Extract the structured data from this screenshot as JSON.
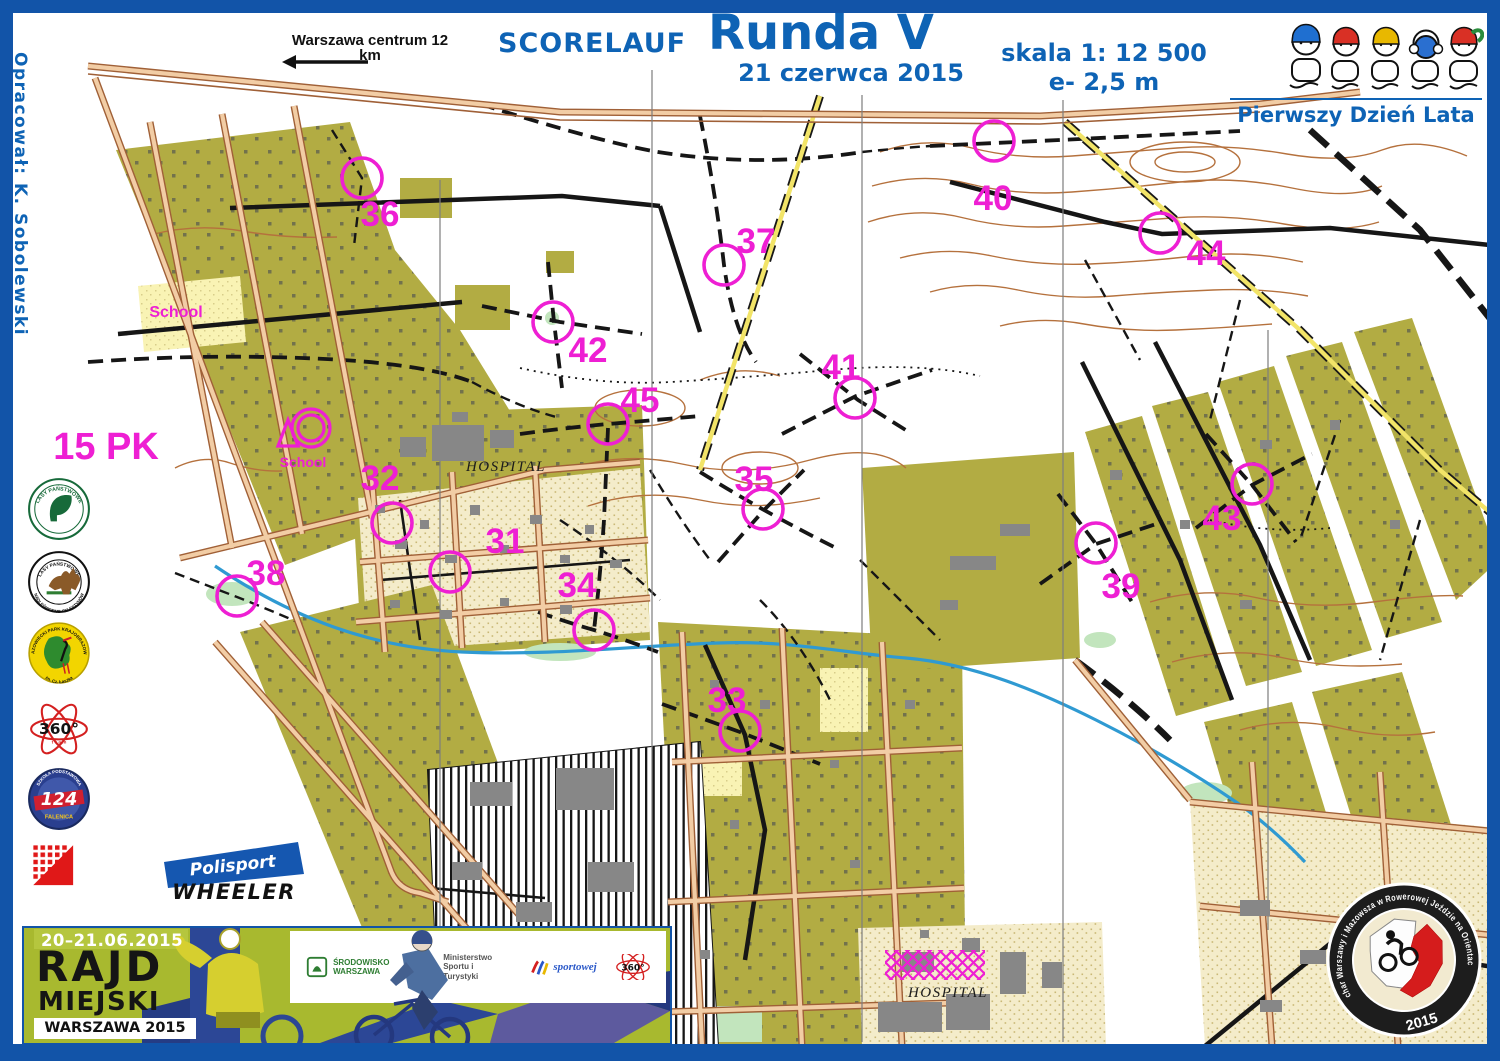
{
  "frame": {
    "border_color": "#1254a8",
    "background": "#ffffff"
  },
  "header": {
    "direction_note": "Warszawa centrum 12 km",
    "event_type": "SCORELAUF",
    "title": "Runda V",
    "date": "21 czerwca 2015",
    "scale": "skala 1: 12 500",
    "equidistance": "e- 2,5 m",
    "season_note": "Pierwszy Dzień Lata",
    "author": "Opracował: K. Sobolewski"
  },
  "map": {
    "control_color": "#ee1fd3",
    "controls": [
      {
        "num": "31",
        "cx": 450,
        "cy": 572,
        "lx": 505,
        "ly": 553
      },
      {
        "num": "32",
        "cx": 392,
        "cy": 523,
        "lx": 380,
        "ly": 490
      },
      {
        "num": "33",
        "cx": 740,
        "cy": 731,
        "lx": 727,
        "ly": 712
      },
      {
        "num": "34",
        "cx": 594,
        "cy": 630,
        "lx": 577,
        "ly": 597
      },
      {
        "num": "35",
        "cx": 763,
        "cy": 509,
        "lx": 754,
        "ly": 491
      },
      {
        "num": "36",
        "cx": 362,
        "cy": 178,
        "lx": 380,
        "ly": 226
      },
      {
        "num": "37",
        "cx": 724,
        "cy": 265,
        "lx": 756,
        "ly": 253
      },
      {
        "num": "38",
        "cx": 237,
        "cy": 596,
        "lx": 266,
        "ly": 585
      },
      {
        "num": "39",
        "cx": 1096,
        "cy": 543,
        "lx": 1121,
        "ly": 598
      },
      {
        "num": "40",
        "cx": 994,
        "cy": 141,
        "lx": 993,
        "ly": 210
      },
      {
        "num": "41",
        "cx": 855,
        "cy": 398,
        "lx": 841,
        "ly": 379
      },
      {
        "num": "42",
        "cx": 553,
        "cy": 322,
        "lx": 588,
        "ly": 362
      },
      {
        "num": "43",
        "cx": 1252,
        "cy": 484,
        "lx": 1222,
        "ly": 530
      },
      {
        "num": "44",
        "cx": 1160,
        "cy": 233,
        "lx": 1206,
        "ly": 265
      },
      {
        "num": "45",
        "cx": 608,
        "cy": 424,
        "lx": 640,
        "ly": 412
      }
    ],
    "labels": [
      {
        "text": "15 PK",
        "x": 106,
        "y": 459,
        "cls": "lbl-big"
      },
      {
        "text": "School",
        "x": 176,
        "y": 317,
        "cls": "lbl-school"
      },
      {
        "text": "School",
        "x": 303,
        "y": 467,
        "cls": "lbl-school-sm"
      },
      {
        "text": "HOSPITAL",
        "x": 506,
        "y": 471,
        "cls": "lbl-hosp"
      },
      {
        "text": "HOSPITAL",
        "x": 948,
        "y": 997,
        "cls": "lbl-hosp"
      },
      {
        "text": "SZPITAL CENTRUM ZDROWIA DZIECKA",
        "x": 990,
        "y": 1057,
        "cls": "lbl-hosp-sm"
      }
    ]
  },
  "sponsors": {
    "lasy_panstwowe": "LASY PAŃSTWOWE",
    "nadlesnictwo_top": "LASY PAŃSTWOWE",
    "nadlesnictwo_bottom": "NADLEŚNICTWO CELESTYNÓW",
    "park_top": "MAZOWIECKI PARK KRAJOBRAZOWY",
    "park_bottom": "im. Cz. Łaszka",
    "team360": "360°",
    "team360_sub": "t e a m",
    "school_number": "124",
    "school_top": "SZKOŁA PODSTAWOWA",
    "school_bottom": "FALENICA",
    "polisport": "Polisport",
    "wheeler": "WHEELER"
  },
  "banner": {
    "dates": "20–21.06.2015",
    "title_line1": "RAJD",
    "title_line2": "MIEJSKI",
    "subtitle": "WARSZAWA 2015",
    "partner_logos": [
      {
        "id": "srodowisko-warszawa",
        "text": "ŚRODOWISKO WARSZAWA"
      },
      {
        "id": "ministerstwo-sportu",
        "text": "Ministerstwo Sportu i Turystyki"
      },
      {
        "id": "sportowej",
        "text": "sportowej"
      },
      {
        "id": "360-team",
        "text": "360°"
      }
    ]
  },
  "badge": {
    "ring_text": "Puchar Warszawy i Mazowsza w Rowerowej Jeździe na Orientację",
    "year": "2015"
  }
}
